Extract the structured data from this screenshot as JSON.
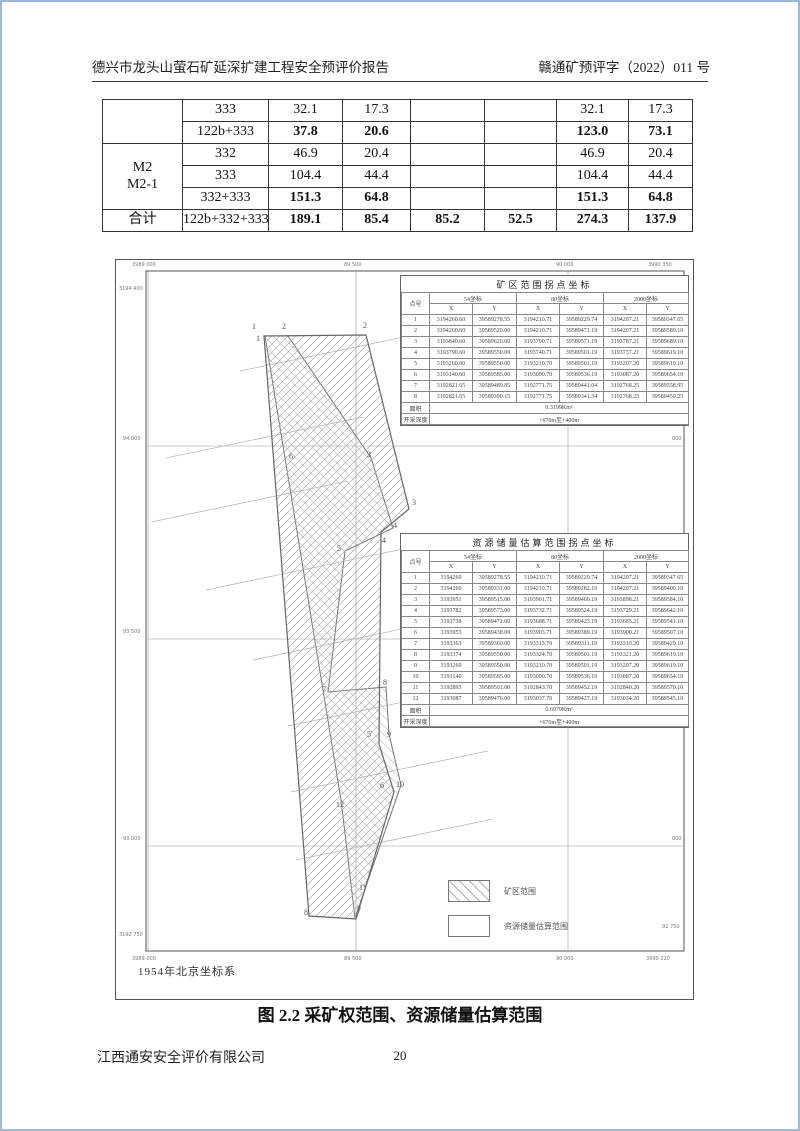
{
  "page": {
    "header_left": "德兴市龙头山萤石矿延深扩建工程安全预评价报告",
    "header_right": "赣通矿预评字（2022）011 号",
    "caption": "图 2.2 采矿权范围、资源储量估算范围",
    "footer_company": "江西通安安全评价有限公司",
    "page_number": "20"
  },
  "main_table": {
    "rows": [
      {
        "cells": [
          {
            "t": "",
            "rs": 2
          },
          {
            "t": "333"
          },
          {
            "t": "32.1"
          },
          {
            "t": "17.3"
          },
          {
            "t": ""
          },
          {
            "t": ""
          },
          {
            "t": "32.1"
          },
          {
            "t": "17.3"
          }
        ]
      },
      {
        "cells": [
          {
            "t": "122b+333"
          },
          {
            "t": "37.8",
            "b": 1
          },
          {
            "t": "20.6",
            "b": 1
          },
          {
            "t": ""
          },
          {
            "t": ""
          },
          {
            "t": "123.0",
            "b": 1
          },
          {
            "t": "73.1",
            "b": 1
          }
        ]
      },
      {
        "cells": [
          {
            "t": "M2\nM2-1",
            "rs": 3
          },
          {
            "t": "332"
          },
          {
            "t": "46.9"
          },
          {
            "t": "20.4"
          },
          {
            "t": ""
          },
          {
            "t": ""
          },
          {
            "t": "46.9"
          },
          {
            "t": "20.4"
          }
        ]
      },
      {
        "cells": [
          {
            "t": "333"
          },
          {
            "t": "104.4"
          },
          {
            "t": "44.4"
          },
          {
            "t": ""
          },
          {
            "t": ""
          },
          {
            "t": "104.4"
          },
          {
            "t": "44.4"
          }
        ]
      },
      {
        "cells": [
          {
            "t": "332+333"
          },
          {
            "t": "151.3",
            "b": 1
          },
          {
            "t": "64.8",
            "b": 1
          },
          {
            "t": ""
          },
          {
            "t": ""
          },
          {
            "t": "151.3",
            "b": 1
          },
          {
            "t": "64.8",
            "b": 1
          }
        ]
      },
      {
        "cells": [
          {
            "t": "合计"
          },
          {
            "t": "122b+332+333"
          },
          {
            "t": "189.1",
            "b": 1
          },
          {
            "t": "85.4",
            "b": 1
          },
          {
            "t": "85.2",
            "b": 1
          },
          {
            "t": "52.5",
            "b": 1
          },
          {
            "t": "274.3",
            "b": 1
          },
          {
            "t": "137.9",
            "b": 1
          }
        ]
      }
    ]
  },
  "map": {
    "coordinate_system_note": "1954年北京坐标系",
    "legend": [
      {
        "label": "矿区范围",
        "swatch": "hatched"
      },
      {
        "label": "资源储量估算范围",
        "swatch": "plain"
      }
    ],
    "grid_labels": [
      {
        "t": "3989 000",
        "x": 16,
        "y": 2
      },
      {
        "t": "89 500",
        "x": 228,
        "y": 2
      },
      {
        "t": "90 000",
        "x": 440,
        "y": 2
      },
      {
        "t": "3990 350",
        "x": 532,
        "y": 2
      },
      {
        "t": "3194 400",
        "x": 3,
        "y": 26
      },
      {
        "t": "94 000",
        "x": 7,
        "y": 176
      },
      {
        "t": "93 500",
        "x": 7,
        "y": 369
      },
      {
        "t": "93 000",
        "x": 7,
        "y": 576
      },
      {
        "t": "3192 750",
        "x": 3,
        "y": 672
      },
      {
        "t": "400",
        "x": 556,
        "y": 30
      },
      {
        "t": "000",
        "x": 556,
        "y": 176
      },
      {
        "t": "500",
        "x": 556,
        "y": 369
      },
      {
        "t": "000",
        "x": 556,
        "y": 576
      },
      {
        "t": "92 750",
        "x": 546,
        "y": 664
      },
      {
        "t": "3989 000",
        "x": 16,
        "y": 696
      },
      {
        "t": "89 500",
        "x": 228,
        "y": 696
      },
      {
        "t": "90 000",
        "x": 440,
        "y": 696
      },
      {
        "t": "3990 220",
        "x": 530,
        "y": 696
      }
    ],
    "mining_points": [
      {
        "n": "1",
        "x": 136,
        "y": 62
      },
      {
        "n": "2",
        "x": 247,
        "y": 61
      },
      {
        "n": "3",
        "x": 296,
        "y": 238
      },
      {
        "n": "4",
        "x": 277,
        "y": 261
      },
      {
        "n": "5",
        "x": 251,
        "y": 470
      },
      {
        "n": "6",
        "x": 264,
        "y": 521
      },
      {
        "n": "7",
        "x": 241,
        "y": 646
      },
      {
        "n": "8",
        "x": 188,
        "y": 648
      }
    ],
    "resource_points": [
      {
        "n": "1",
        "x": 140,
        "y": 74
      },
      {
        "n": "2",
        "x": 166,
        "y": 62
      },
      {
        "n": "3",
        "x": 251,
        "y": 190
      },
      {
        "n": "4",
        "x": 266,
        "y": 276
      },
      {
        "n": "5",
        "x": 221,
        "y": 284
      },
      {
        "n": "6",
        "x": 173,
        "y": 192
      },
      {
        "n": "7",
        "x": 206,
        "y": 425
      },
      {
        "n": "8",
        "x": 267,
        "y": 418
      },
      {
        "n": "9",
        "x": 271,
        "y": 470
      },
      {
        "n": "10",
        "x": 280,
        "y": 520
      },
      {
        "n": "11",
        "x": 243,
        "y": 623
      },
      {
        "n": "12",
        "x": 220,
        "y": 540
      }
    ],
    "tableA": {
      "title": "矿区范围拐点坐标",
      "col_point": "点号",
      "groups": [
        "54坐标",
        "80坐标",
        "2000坐标"
      ],
      "xy": [
        "X",
        "Y"
      ],
      "rows": [
        [
          "1",
          "3194260.60",
          "39589278.55",
          "3194210.71",
          "39589229.74",
          "3194207.21",
          "39589347.65"
        ],
        [
          "2",
          "3194260.60",
          "39589520.00",
          "3194210.71",
          "39589471.19",
          "3194207.21",
          "39589589.10"
        ],
        [
          "3",
          "3193840.60",
          "39589620.00",
          "3193790.71",
          "39589571.19",
          "3193787.21",
          "39589689.10"
        ],
        [
          "4",
          "3193790.60",
          "39589550.00",
          "3193740.71",
          "39589501.19",
          "3193737.21",
          "39589619.10"
        ],
        [
          "5",
          "3193260.60",
          "39589550.00",
          "3193210.70",
          "39589501.19",
          "3193207.20",
          "39589619.10"
        ],
        [
          "6",
          "3193140.60",
          "39589585.00",
          "3193090.70",
          "39589536.19",
          "3193087.20",
          "39589654.10"
        ],
        [
          "7",
          "3192821.65",
          "39589489.85",
          "3192771.75",
          "39589441.04",
          "3192768.25",
          "39589558.95"
        ],
        [
          "8",
          "3192821.65",
          "39589390.15",
          "3192771.75",
          "39589341.34",
          "3192768.25",
          "39589459.25"
        ]
      ],
      "area_label": "面积",
      "area_value": "0.3199Km²",
      "depth_label": "开采深度",
      "depth_value": "+670m至+400m"
    },
    "tableB": {
      "title": "资源储量估算范围拐点坐标",
      "col_point": "点号",
      "groups": [
        "54坐标",
        "80坐标",
        "2000坐标"
      ],
      "xy": [
        "X",
        "Y"
      ],
      "rows": [
        [
          "1",
          "3194260",
          "39589278.55",
          "3194210.71",
          "39589229.74",
          "3194207.21",
          "39589347.65"
        ],
        [
          "2",
          "3194260",
          "39589331.00",
          "3194210.71",
          "39589282.19",
          "3194207.21",
          "39589400.10"
        ],
        [
          "3",
          "3193951",
          "39589515.00",
          "3193901.71",
          "39589466.19",
          "3193898.21",
          "39589584.10"
        ],
        [
          "4",
          "3193782",
          "39589573.00",
          "3193732.71",
          "39589524.19",
          "3193729.21",
          "39589642.10"
        ],
        [
          "5",
          "3193738",
          "39589472.00",
          "3193688.71",
          "39589423.19",
          "3193685.21",
          "39589541.10"
        ],
        [
          "6",
          "3193953",
          "39589438.00",
          "3193903.71",
          "39589389.19",
          "3193900.21",
          "39589507.10"
        ],
        [
          "7",
          "3193363",
          "39589360.00",
          "3193313.70",
          "39589311.19",
          "3193310.20",
          "39589429.10"
        ],
        [
          "8",
          "3193374",
          "39589550.00",
          "3193324.70",
          "39589501.19",
          "3193321.20",
          "39589619.10"
        ],
        [
          "9",
          "3193260",
          "39589550.00",
          "3193210.70",
          "39589501.19",
          "3193207.20",
          "39589619.10"
        ],
        [
          "10",
          "3193140",
          "39589585.00",
          "3193090.70",
          "39589536.19",
          "3193087.20",
          "39589654.10"
        ],
        [
          "11",
          "3192893",
          "39589501.00",
          "3192843.70",
          "39589452.19",
          "3192840.20",
          "39589570.10"
        ],
        [
          "12",
          "3193087",
          "39589476.00",
          "3193037.70",
          "39589427.19",
          "3193034.20",
          "39589545.10"
        ]
      ],
      "area_label": "面积",
      "area_value": "0.6979Km²",
      "depth_label": "开采深度",
      "depth_value": "+670m至+400m"
    }
  }
}
